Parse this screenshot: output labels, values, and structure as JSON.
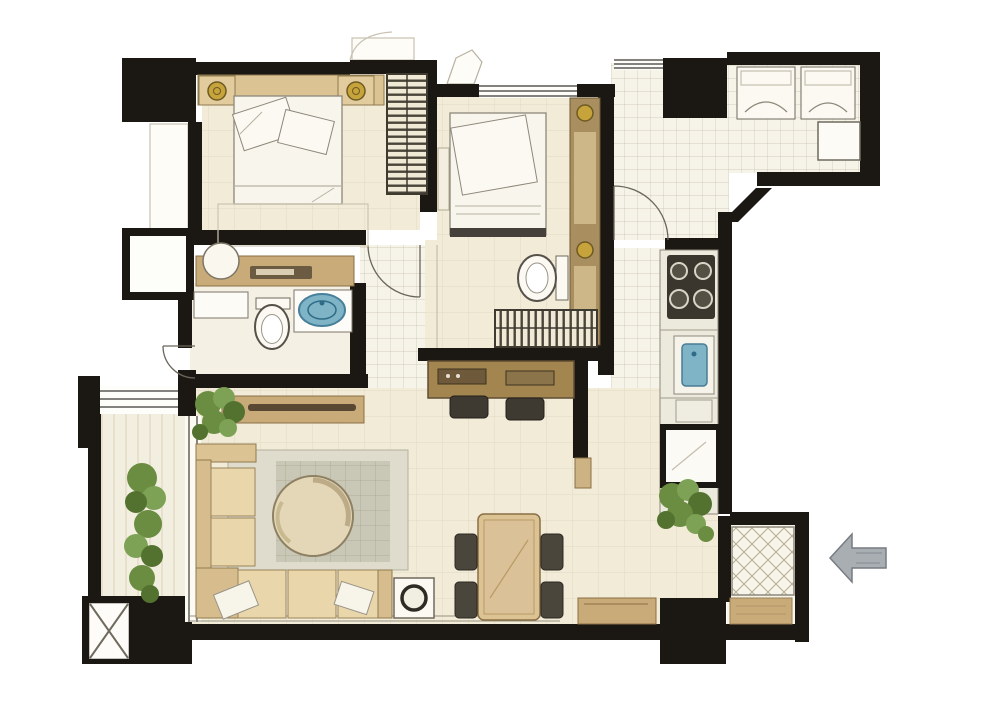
{
  "meta": {
    "type": "residential-apartment-floor-plan",
    "style": "hand-rendered-watercolor",
    "visible_text": "none",
    "entry_arrow_direction": "left"
  },
  "canvas": {
    "width": 1000,
    "height": 703,
    "background": "#ffffff"
  },
  "colors": {
    "wall": "#1b1713",
    "floor_cream": "#f1ebd8",
    "floor_tile": "#f6f3e8",
    "tile_line": "#b9b09b",
    "soft_line": "#ddd4bd",
    "furniture_tan": "#dcc394",
    "furniture_tan_dark": "#c9ab79",
    "wood_brown": "#a3854f",
    "wood_dark": "#5f4d33",
    "linen_white": "#f8f5ec",
    "outline_grey": "#8e877b",
    "rug_outer": "#dfdccd",
    "rug_inner": "#c9c7b5",
    "water_blue": "#7fb3c6",
    "water_blue_dark": "#47809b",
    "lamp_gold": "#c7a33b",
    "plant_green": "#6b8d41",
    "plant_green_light": "#7da255",
    "plant_green_dark": "#53722f",
    "appliance_dark": "#3a362e",
    "arrow_grey": "#a9aeb3",
    "arrow_grey_dark": "#767c81",
    "lattice_line": "#b5ac92"
  },
  "rooms": [
    {
      "id": "bedroom-1",
      "position": "top-left",
      "furniture": [
        "double-bed",
        "two-nightstands-with-lamps",
        "wardrobe",
        "rug"
      ]
    },
    {
      "id": "master-bedroom",
      "position": "top-center",
      "furniture": [
        "double-bed",
        "tall-cabinet-with-gold-knobs",
        "bench"
      ]
    },
    {
      "id": "master-bathroom-dressing",
      "position": "center",
      "furniture": [
        "toilet",
        "hanging-closet"
      ]
    },
    {
      "id": "shared-bathroom",
      "position": "middle-left",
      "furniture": [
        "vanity-counter",
        "wash-basin",
        "toilet",
        "round-blue-sink"
      ]
    },
    {
      "id": "hallway",
      "position": "top-center-right",
      "furniture": [
        "door-swing"
      ]
    },
    {
      "id": "utility-balcony",
      "position": "top-right",
      "furniture": [
        "two-appliances",
        "water-heater"
      ]
    },
    {
      "id": "kitchen",
      "position": "right",
      "furniture": [
        "four-burner-stove",
        "blue-sink",
        "refrigerator",
        "counter-run"
      ]
    },
    {
      "id": "corridor",
      "position": "middle-left",
      "furniture": [
        "console-table",
        "potted-plant"
      ]
    },
    {
      "id": "study-nook",
      "position": "center",
      "furniture": [
        "desk",
        "two-stools"
      ]
    },
    {
      "id": "living-room",
      "position": "bottom-left",
      "furniture": [
        "l-shaped-sofa",
        "round-coffee-table",
        "area-rug",
        "side-table-with-lamp",
        "throw-pillows"
      ]
    },
    {
      "id": "dining-area",
      "position": "bottom-center",
      "furniture": [
        "dining-table",
        "four-chairs",
        "sideboard",
        "potted-plant"
      ]
    },
    {
      "id": "foyer",
      "position": "bottom-right",
      "furniture": [
        "lattice-tile-floor",
        "doormat"
      ]
    },
    {
      "id": "side-balcony",
      "position": "left",
      "furniture": [
        "tall-potted-plant"
      ]
    }
  ],
  "symbols": {
    "structural_columns": 4,
    "shaft_box": "black block with white X panel, bottom-left",
    "ac_ledge": "white box on left exterior wall",
    "entry_arrow": "grey arrow outside right wall pointing left",
    "windows": [
      "master-bedroom-top",
      "hallway-top",
      "left-balcony",
      "living-room-bottom"
    ]
  }
}
